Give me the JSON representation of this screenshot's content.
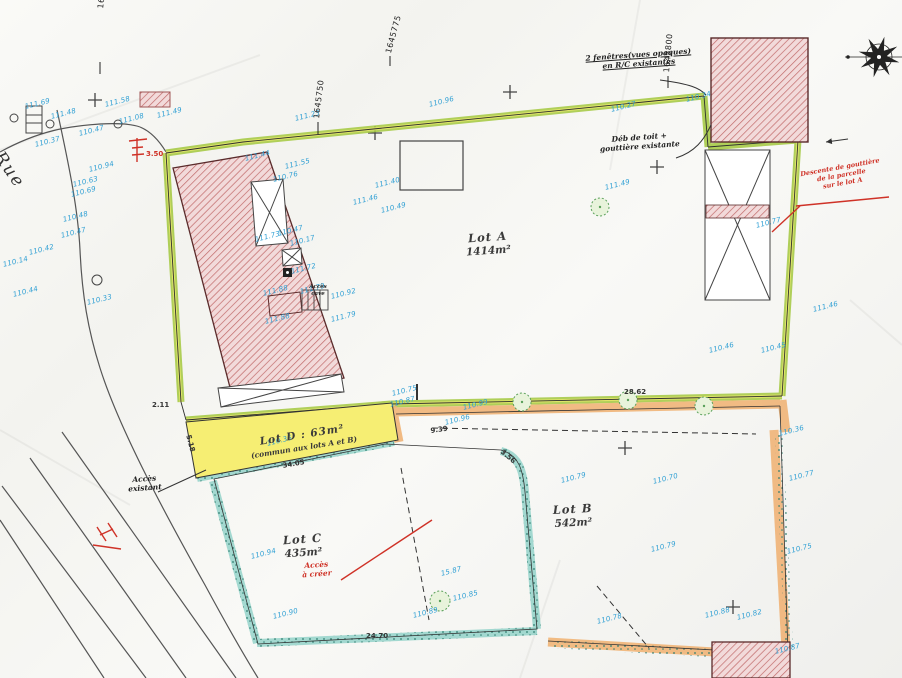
{
  "lots": {
    "a": {
      "name": "Lot A",
      "area": "1414m²"
    },
    "b": {
      "name": "Lot B",
      "area": "542m²"
    },
    "c": {
      "name": "Lot C",
      "area": "435m²"
    },
    "d": {
      "name": "Lot D : 63m²",
      "note": "(commun aux lots A et B)"
    }
  },
  "street": {
    "name": "Rue"
  },
  "colors": {
    "boundary_green": "#a3c83e",
    "boundary_yellow": "#e3e66a",
    "band_orange": "#f0b070",
    "band_teal": "#6cc5b9",
    "lot_d_yellow": "#f6ee73",
    "hatch_red": "#c16a6a",
    "measure_blue": "#2e9fd4",
    "annotation_red": "#cf3227"
  },
  "grid_labels": [
    {
      "t": "1645725",
      "x": 96,
      "y": 8,
      "rot": -83
    },
    {
      "t": "1645750",
      "x": 312,
      "y": 118,
      "rot": -83
    },
    {
      "t": "1645775",
      "x": 384,
      "y": 52,
      "rot": -75
    },
    {
      "t": "1645800",
      "x": 662,
      "y": 72,
      "rot": -85
    }
  ],
  "annotations": {
    "windows_line1": "2 fenêtres(vues opaques)",
    "windows_line2": "en R/C existantes",
    "roof_line1": "Déb de toit +",
    "roof_line2": "gouttière existante",
    "gutter_line1": "Descente de gouttière",
    "gutter_line2": "de la parcelle",
    "gutter_line3": "sur le lot A",
    "access_existing_line1": "Accès",
    "access_existing_line2": "existant",
    "access_new_line1": "Accès",
    "access_new_line2": "à créer",
    "cellar_line1": "Accès",
    "cellar_line2": "cave"
  },
  "measurements": [
    {
      "t": "111.69",
      "x": 24,
      "y": 103
    },
    {
      "t": "111.58",
      "x": 104,
      "y": 101
    },
    {
      "t": "111.48",
      "x": 50,
      "y": 113
    },
    {
      "t": "111.49",
      "x": 156,
      "y": 112
    },
    {
      "t": "111.08",
      "x": 118,
      "y": 118
    },
    {
      "t": "110.47",
      "x": 78,
      "y": 130
    },
    {
      "t": "110.37",
      "x": 34,
      "y": 141
    },
    {
      "t": "110.94",
      "x": 88,
      "y": 166
    },
    {
      "t": "110.63",
      "x": 72,
      "y": 181
    },
    {
      "t": "110.69",
      "x": 70,
      "y": 191
    },
    {
      "t": "110.48",
      "x": 62,
      "y": 216
    },
    {
      "t": "110.47",
      "x": 60,
      "y": 232
    },
    {
      "t": "110.42",
      "x": 28,
      "y": 249
    },
    {
      "t": "110.14",
      "x": 2,
      "y": 261
    },
    {
      "t": "110.44",
      "x": 12,
      "y": 291
    },
    {
      "t": "110.33",
      "x": 86,
      "y": 299
    },
    {
      "t": "111.23",
      "x": 294,
      "y": 115
    },
    {
      "t": "110.96",
      "x": 428,
      "y": 101
    },
    {
      "t": "110.27",
      "x": 610,
      "y": 106
    },
    {
      "t": "110.34",
      "x": 685,
      "y": 96
    },
    {
      "t": "111.55",
      "x": 284,
      "y": 163
    },
    {
      "t": "110.76",
      "x": 272,
      "y": 176
    },
    {
      "t": "111.44",
      "x": 244,
      "y": 155
    },
    {
      "t": "111.46",
      "x": 352,
      "y": 199
    },
    {
      "t": "111.49",
      "x": 604,
      "y": 184
    },
    {
      "t": "110.47",
      "x": 277,
      "y": 230
    },
    {
      "t": "110.17",
      "x": 289,
      "y": 240
    },
    {
      "t": "111.73",
      "x": 254,
      "y": 236
    },
    {
      "t": "111.72",
      "x": 290,
      "y": 268
    },
    {
      "t": "111.88",
      "x": 262,
      "y": 290
    },
    {
      "t": "111.79",
      "x": 299,
      "y": 288
    },
    {
      "t": "110.92",
      "x": 330,
      "y": 293
    },
    {
      "t": "111.88",
      "x": 264,
      "y": 318
    },
    {
      "t": "111.79",
      "x": 330,
      "y": 316
    },
    {
      "t": "110.77",
      "x": 755,
      "y": 222
    },
    {
      "t": "111.46",
      "x": 812,
      "y": 306
    },
    {
      "t": "110.45",
      "x": 760,
      "y": 347
    },
    {
      "t": "110.46",
      "x": 708,
      "y": 347
    },
    {
      "t": "110.75",
      "x": 391,
      "y": 390
    },
    {
      "t": "110.87",
      "x": 389,
      "y": 401
    },
    {
      "t": "110.96",
      "x": 444,
      "y": 419
    },
    {
      "t": "110.99",
      "x": 462,
      "y": 404
    },
    {
      "t": "110.36",
      "x": 266,
      "y": 440
    },
    {
      "t": "110.94",
      "x": 250,
      "y": 553
    },
    {
      "t": "15.87",
      "x": 440,
      "y": 570
    },
    {
      "t": "110.90",
      "x": 272,
      "y": 613
    },
    {
      "t": "110.89",
      "x": 412,
      "y": 612
    },
    {
      "t": "110.85",
      "x": 452,
      "y": 595
    },
    {
      "t": "110.79",
      "x": 560,
      "y": 477
    },
    {
      "t": "110.70",
      "x": 652,
      "y": 478
    },
    {
      "t": "110.79",
      "x": 650,
      "y": 546
    },
    {
      "t": "110.77",
      "x": 788,
      "y": 475
    },
    {
      "t": "110.75",
      "x": 786,
      "y": 548
    },
    {
      "t": "110.88",
      "x": 704,
      "y": 612
    },
    {
      "t": "110.82",
      "x": 736,
      "y": 614
    },
    {
      "t": "110.87",
      "x": 774,
      "y": 648
    },
    {
      "t": "110.78",
      "x": 596,
      "y": 618
    },
    {
      "t": "110.36",
      "x": 778,
      "y": 430
    },
    {
      "t": "110.49",
      "x": 380,
      "y": 207
    },
    {
      "t": "111.40",
      "x": 374,
      "y": 182
    }
  ],
  "dimensions": [
    {
      "t": "28.62",
      "x": 624,
      "y": 388
    },
    {
      "t": "24.70",
      "x": 366,
      "y": 632
    },
    {
      "t": "9.39",
      "x": 430,
      "y": 427,
      "rot": -8
    },
    {
      "t": "3.56",
      "x": 504,
      "y": 448,
      "rot": 40
    },
    {
      "t": "34.05",
      "x": 282,
      "y": 462,
      "rot": -10
    },
    {
      "t": "5.18",
      "x": 192,
      "y": 434,
      "rot": 75
    },
    {
      "t": "2.11",
      "x": 152,
      "y": 401
    },
    {
      "t": "3.50",
      "x": 146,
      "y": 150,
      "c": "#cf3227"
    }
  ]
}
